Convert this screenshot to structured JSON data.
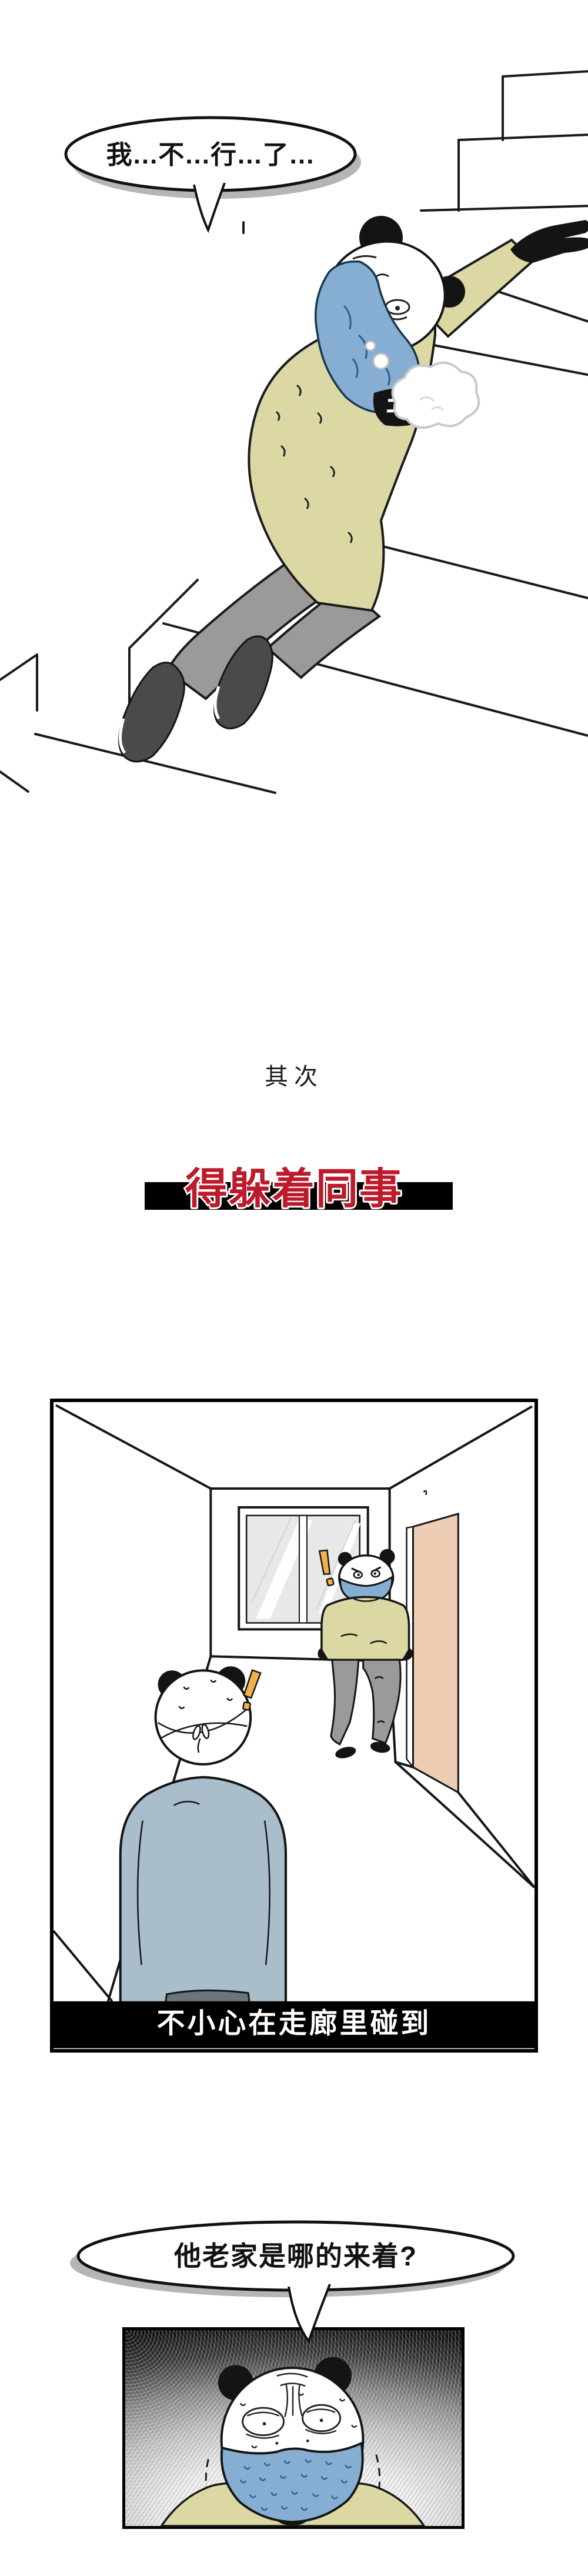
{
  "texts": {
    "bubble_stairs": "我...不...行...了...",
    "secondly": "其次",
    "headline": "得躲着同事",
    "hallway_caption": "不小心在走廊里碰到",
    "bubble_hometown": "他老家是哪的来着?"
  },
  "colors": {
    "mask_blue": "#85aed2",
    "mask_fold_blue": "#2b5f8e",
    "shirt_khaki": "#dbd8a4",
    "pants_gray": "#9a9a9a",
    "shoe_dark": "#4a4a4a",
    "sweater_blue_gray": "#a9bdcb",
    "waistband_gray": "#69757d",
    "door_pink": "#eecdb5",
    "glass_gray": "#e7e9e9",
    "headline_red": "#bc1b2c",
    "caption_bar_black": "#000000",
    "exclamation_orange": "#f3b14b",
    "outline_black": "#141414",
    "bubble_shadow_gray": "#b5b5b5"
  }
}
